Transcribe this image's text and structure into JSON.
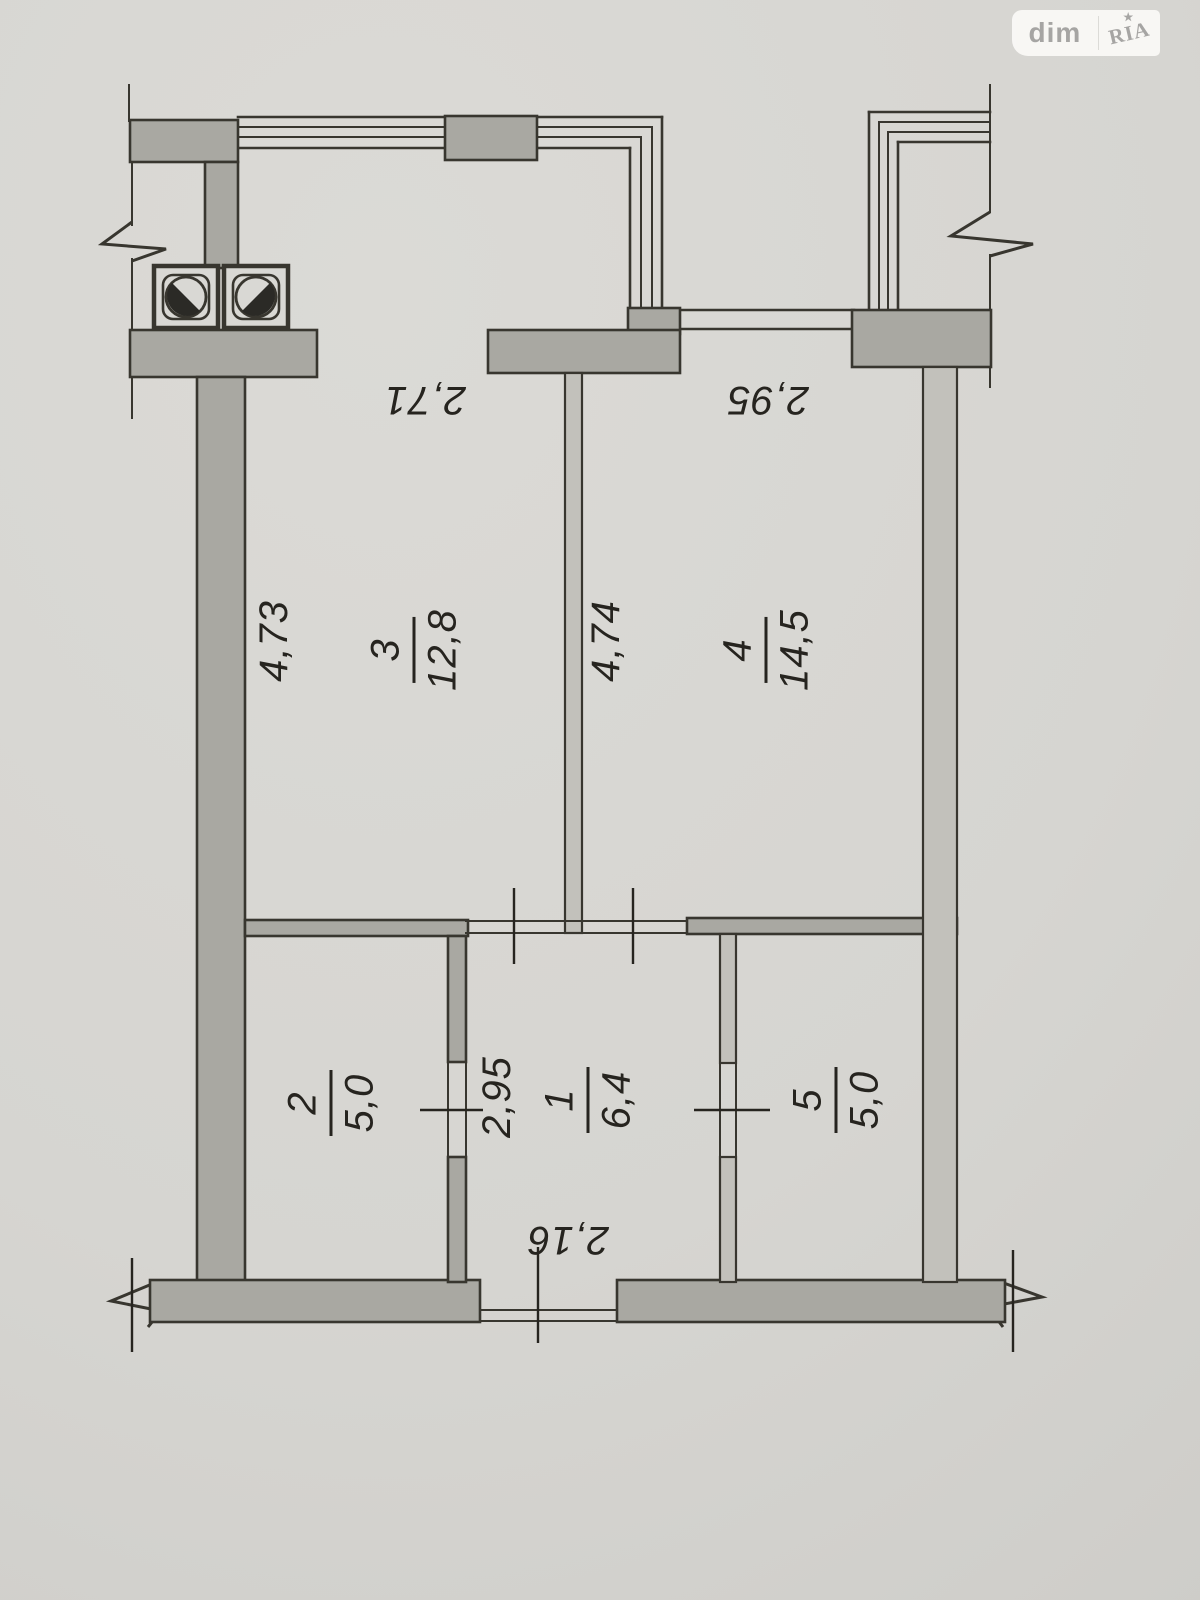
{
  "watermark": {
    "left_text": "dim",
    "right_text": "RIA",
    "star_glyph": "★"
  },
  "floorplan": {
    "type": "apartment-floor-plan",
    "rooms": [
      {
        "id": "room-1",
        "number": "1",
        "area": "6,4"
      },
      {
        "id": "room-2",
        "number": "2",
        "area": "5,0"
      },
      {
        "id": "room-3",
        "number": "3",
        "area": "12,8"
      },
      {
        "id": "room-4",
        "number": "4",
        "area": "14,5"
      },
      {
        "id": "room-5",
        "number": "5",
        "area": "5,0"
      }
    ],
    "dimensions": [
      {
        "id": "room3-width",
        "value": "2,71"
      },
      {
        "id": "room4-width",
        "value": "2,95"
      },
      {
        "id": "room3-depth",
        "value": "4,73"
      },
      {
        "id": "room4-depth",
        "value": "4,74"
      },
      {
        "id": "hall-depth",
        "value": "2,95"
      },
      {
        "id": "hall-width",
        "value": "2,16"
      }
    ]
  },
  "colors": {
    "paper": "#d6d5d1",
    "ink": "#26241f",
    "line": "#38362f",
    "wall-dark": "#a9a8a2",
    "wall-light": "#c2c1bb",
    "logo-bg": "#fbfaf7",
    "logo-text": "#a3a2a0"
  }
}
